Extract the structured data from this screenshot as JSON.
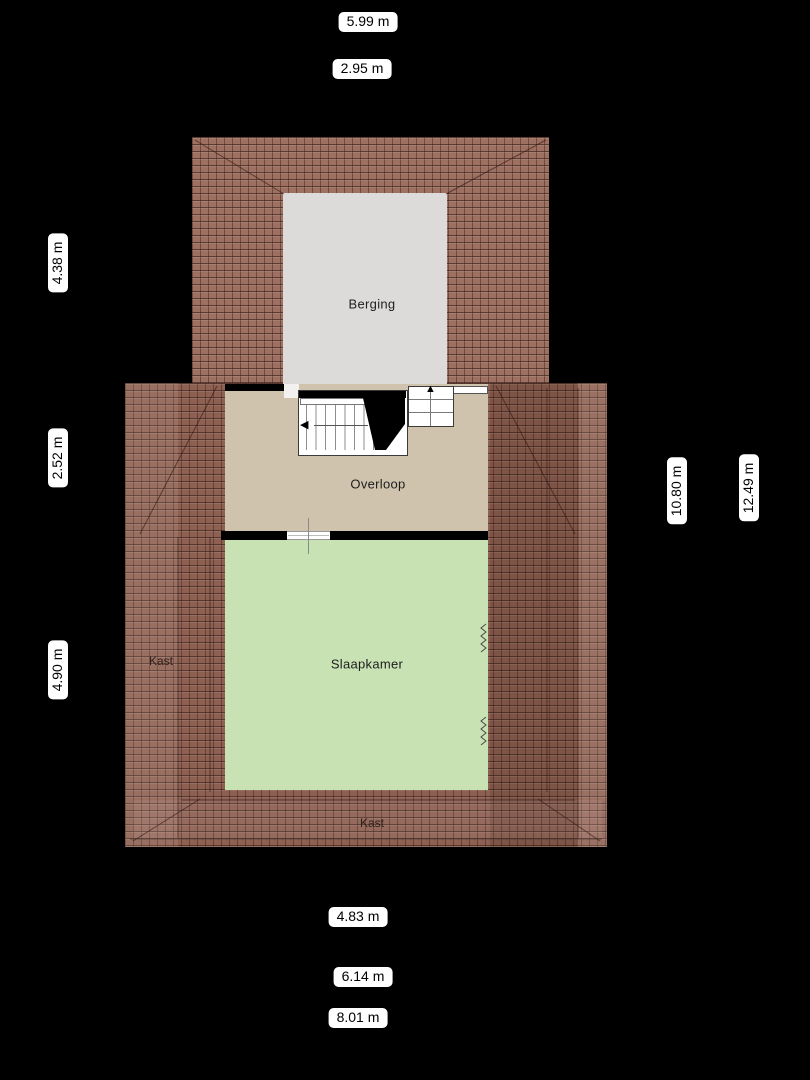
{
  "floorplan": {
    "rooms": {
      "berging": {
        "label": "Berging"
      },
      "overloop": {
        "label": "Overloop"
      },
      "slaapkamer": {
        "label": "Slaapkamer"
      },
      "kast_left": {
        "label": "Kast"
      },
      "kast_bottom": {
        "label": "Kast"
      }
    },
    "dimensions": {
      "top": [
        {
          "label": "5.99 m"
        },
        {
          "label": "2.95 m"
        }
      ],
      "left": [
        {
          "label": "4.38 m"
        },
        {
          "label": "2.52 m"
        },
        {
          "label": "4.90 m"
        }
      ],
      "right": [
        {
          "label": "10.80 m"
        },
        {
          "label": "12.49 m"
        }
      ],
      "bottom": [
        {
          "label": "4.83 m"
        },
        {
          "label": "6.14 m"
        },
        {
          "label": "8.01 m"
        }
      ]
    },
    "icons": {
      "stairs_up_arrow": "▲",
      "stairs_down_arrow": "◀"
    },
    "colors": {
      "background": "#000000",
      "roof_tiles": "#96685A",
      "roof_grout": "#4F322B",
      "berging_floor": "#DCDBD9",
      "overloop_floor": "#CFC3AE",
      "slaapkamer_floor": "#C9E2B4",
      "wall": "#000000",
      "dimension_label_bg": "#FFFFFF",
      "dimension_label_text": "#000000"
    }
  }
}
